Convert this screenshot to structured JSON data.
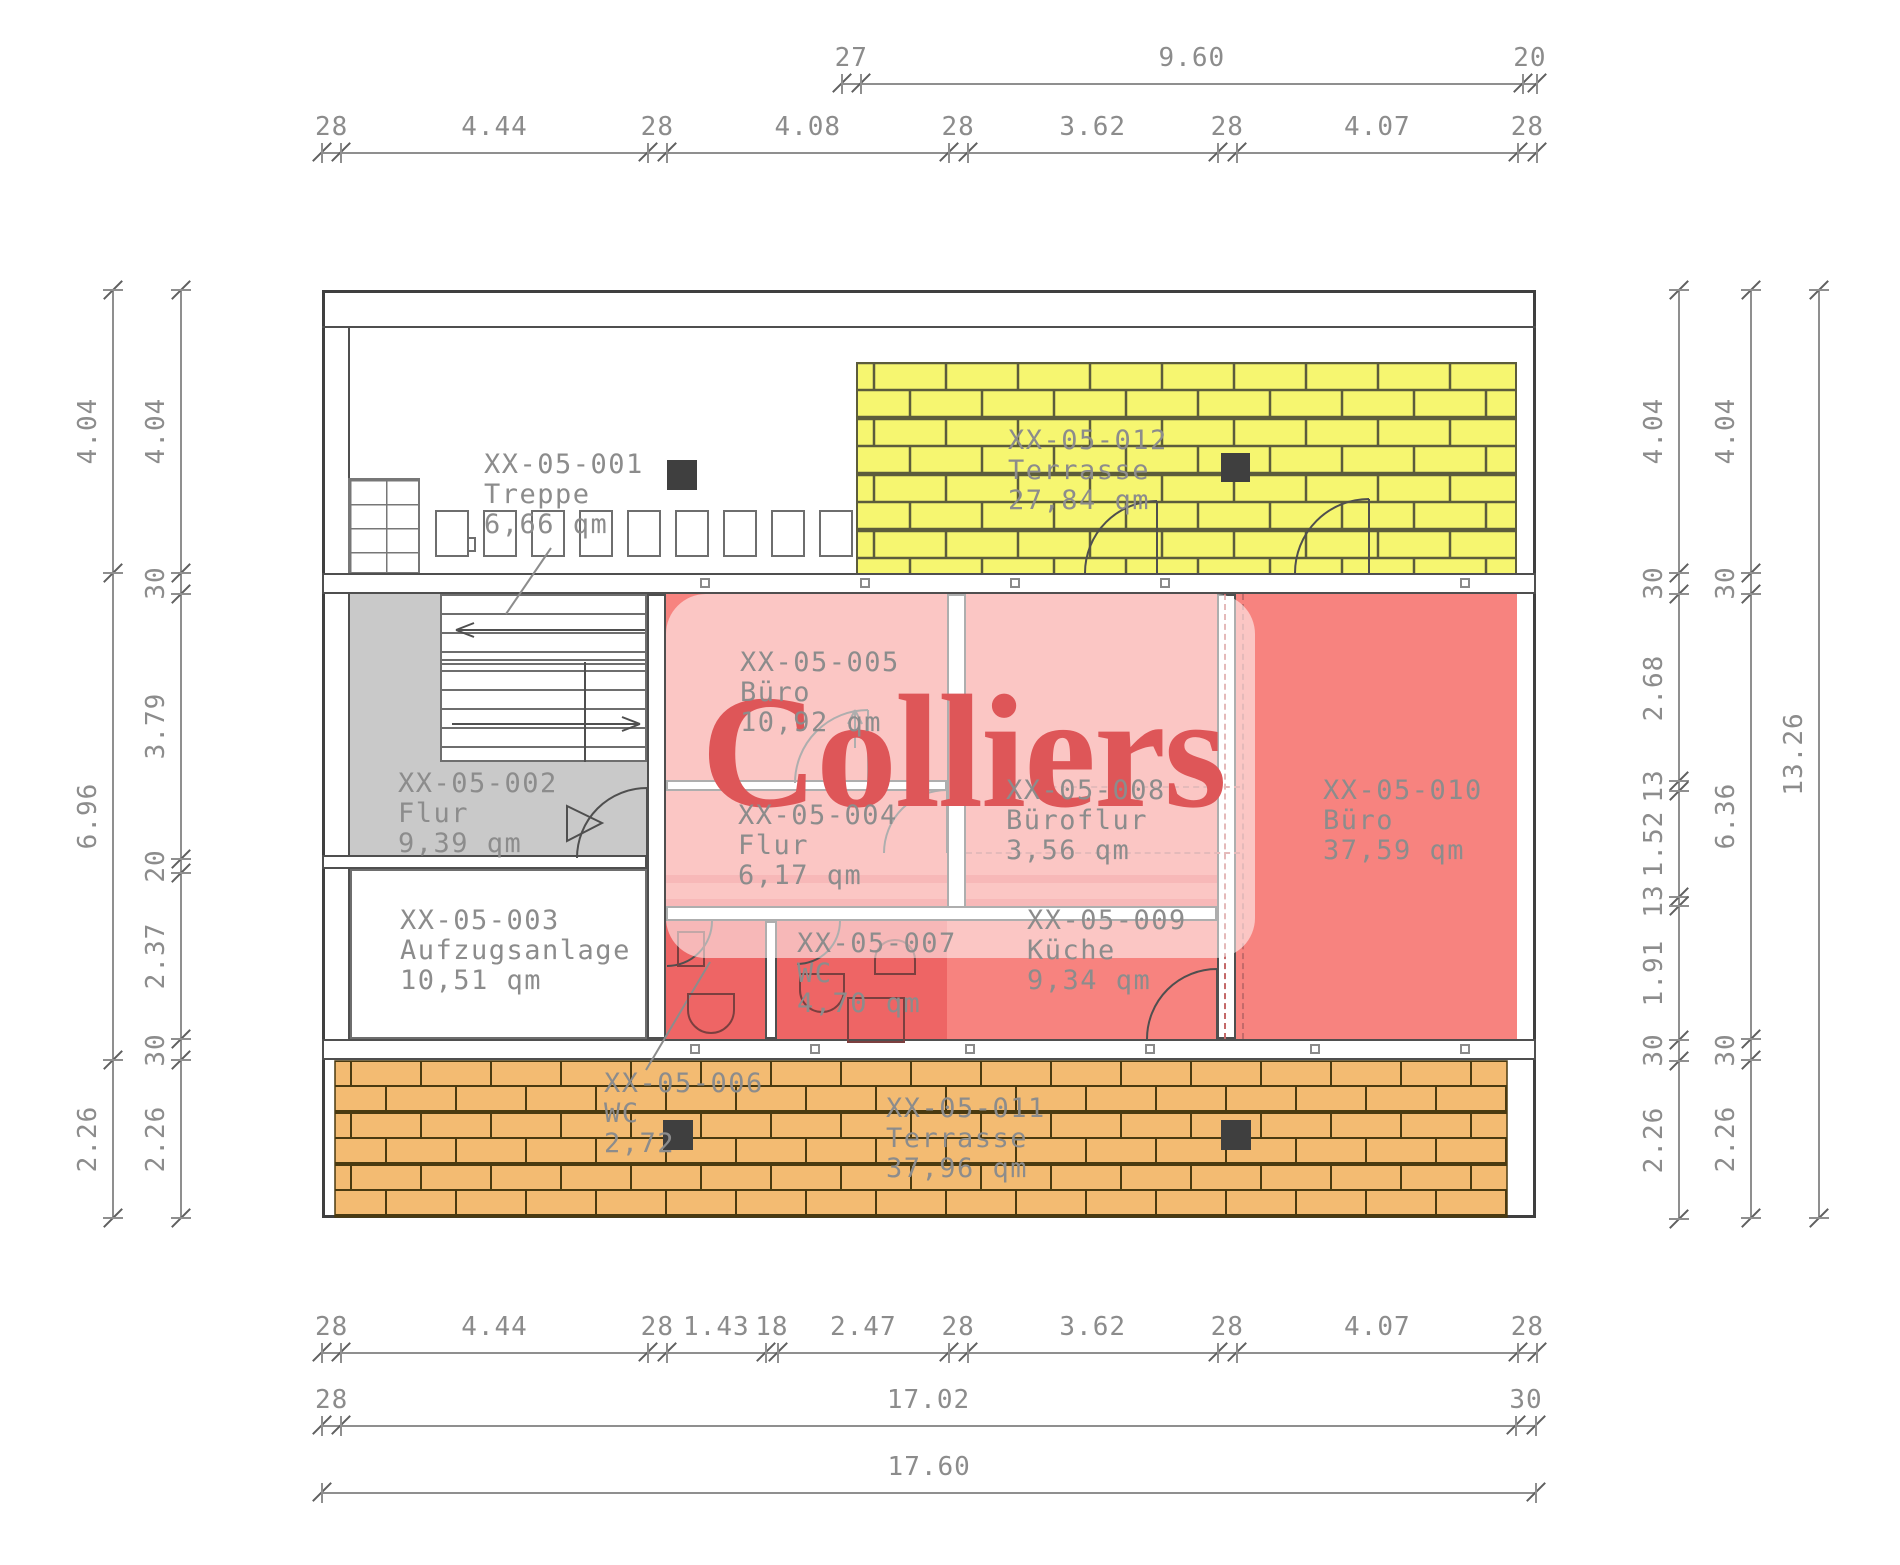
{
  "plan": {
    "watermark": "Colliers",
    "rooms": [
      {
        "id": "XX-05-001",
        "name": "Treppe",
        "area": "6,66 qm"
      },
      {
        "id": "XX-05-002",
        "name": "Flur",
        "area": "9,39 qm"
      },
      {
        "id": "XX-05-003",
        "name": "Aufzugsanlage",
        "area": "10,51 qm"
      },
      {
        "id": "XX-05-004",
        "name": "Flur",
        "area": "6,17 qm"
      },
      {
        "id": "XX-05-005",
        "name": "Büro",
        "area": "10,92 qm"
      },
      {
        "id": "XX-05-006",
        "name": "WC",
        "area": "2,72"
      },
      {
        "id": "XX-05-007",
        "name": "WC",
        "area": "4,70 qm"
      },
      {
        "id": "XX-05-008",
        "name": "Büroflur",
        "area": "3,56 qm"
      },
      {
        "id": "XX-05-009",
        "name": "Küche",
        "area": "9,34 qm"
      },
      {
        "id": "XX-05-010",
        "name": "Büro",
        "area": "37,59 qm"
      },
      {
        "id": "XX-05-011",
        "name": "Terrasse",
        "area": "37,96 qm"
      },
      {
        "id": "XX-05-012",
        "name": "Terrasse",
        "area": "27,84 qm"
      }
    ],
    "dims": {
      "top_terrace": [
        "27",
        "9.60",
        "20"
      ],
      "top_main": [
        "28",
        "4.44",
        "28",
        "4.08",
        "28",
        "3.62",
        "28",
        "4.07",
        "28"
      ],
      "bottom_detail": [
        "28",
        "4.44",
        "28",
        "1.43",
        "18",
        "2.47",
        "28",
        "3.62",
        "28",
        "4.07",
        "28"
      ],
      "bottom_inner": [
        "28",
        "17.02",
        "30"
      ],
      "bottom_total": [
        "17.60"
      ],
      "left_outer": [
        "4.04",
        "6.96",
        "2.26"
      ],
      "left_inner": [
        "4.04",
        "30",
        "3.79",
        "20",
        "2.37",
        "30",
        "2.26"
      ],
      "right_inner": [
        "4.04",
        "30",
        "2.68",
        "13",
        "1.52",
        "13",
        "1.91",
        "30",
        "2.26"
      ],
      "right_middle": [
        "4.04",
        "30",
        "6.36",
        "30",
        "2.26"
      ],
      "right_total": [
        "13.26"
      ]
    },
    "colors": {
      "terrace_top_fill": "#f6f670",
      "terrace_top_line": "#5c5c3c",
      "terrace_bottom_fill": "#f3bb72",
      "terrace_bottom_line": "#4a3a10",
      "room_red": "#f7837f",
      "room_red_dark": "#ee6565",
      "flur_gray": "#c9c9c9",
      "watermark_red": "#de5658",
      "label_gray": "#8c8c8c"
    }
  }
}
